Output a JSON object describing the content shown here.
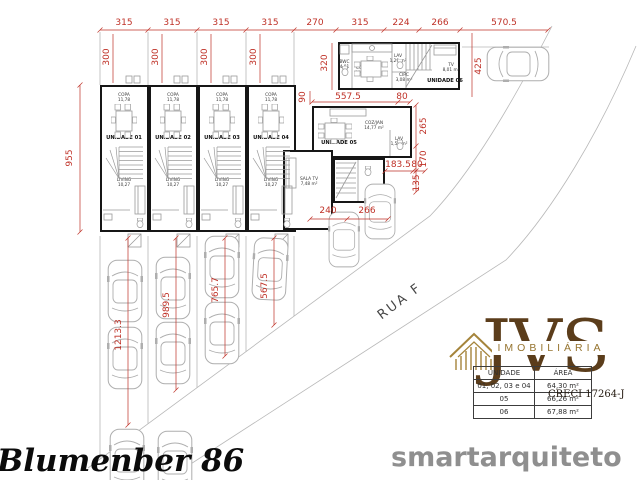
{
  "dims": {
    "top": [
      "315",
      "315",
      "315",
      "315",
      "270",
      "315",
      "224",
      "266",
      "570.5"
    ],
    "depth": "955",
    "front": [
      "300",
      "300",
      "300",
      "300"
    ],
    "u06_depth": "320",
    "gap": "90",
    "drive": "425",
    "u05_w": "557.5",
    "u05_w2": "80",
    "right": [
      "265",
      "170",
      "135"
    ],
    "mid": [
      "183.5",
      "80"
    ],
    "bottom": [
      "240",
      "266"
    ],
    "lanes": [
      "1213.3",
      "989.5",
      "765.7",
      "567.5"
    ]
  },
  "units": {
    "row": [
      {
        "name": "UNIDADE 01",
        "room1": "COPA",
        "room1_area": "11,78",
        "room2": "LIVING",
        "room2_area": "10,27"
      },
      {
        "name": "UNIDADE 02",
        "room1": "COPA",
        "room1_area": "11,78",
        "room2": "LIVING",
        "room2_area": "10,27"
      },
      {
        "name": "UNIDADE 03",
        "room1": "COPA",
        "room1_area": "11,78",
        "room2": "LIVING",
        "room2_area": "10,27"
      },
      {
        "name": "UNIDADE 04",
        "room1": "COPA",
        "room1_area": "11,78",
        "room2": "LIVING",
        "room2_area": "10,27"
      }
    ],
    "u05": {
      "name": "UNIDADE 05",
      "coz": "COZ/JAN",
      "coz_area": "14,77 m²",
      "lav": "LAV",
      "lav_area": "1,50 m²",
      "sala": "SALA TV",
      "sala_area": "7,48 m²"
    },
    "u06": {
      "name": "UNIDADE 06",
      "bwc": "BWC",
      "bwc_area": "4,01 m²",
      "coz": "COZ/JAN",
      "coz_area": "19,06 m²",
      "lav": "LAV",
      "lav_area": "1,29 m²",
      "circ": "CIRC",
      "circ_area": "3,08 m²",
      "tv": "TV",
      "tv_area": "8,01 m²"
    }
  },
  "street": {
    "label": "RUA F"
  },
  "logo": {
    "brand": "JVS",
    "subtitle": "IMOBILIÁRIA",
    "creci": "CRECI 17264-J"
  },
  "area_table": {
    "headers": [
      "UNIDADE",
      "ÁREA"
    ],
    "rows": [
      [
        "01, 02, 03 e 04",
        "64,30 m²"
      ],
      [
        "05",
        "66,26 m²"
      ],
      [
        "06",
        "67,88 m²"
      ]
    ]
  },
  "footer": {
    "project": "Blumenber 86",
    "watermark": "smartarquiteto"
  },
  "colors": {
    "dimension_red": "#bf3127",
    "wall_black": "#161616",
    "brand_brown": "#5b3d1b",
    "brand_gold": "#a5843b",
    "watermark_gray": "#8f8f8f"
  }
}
